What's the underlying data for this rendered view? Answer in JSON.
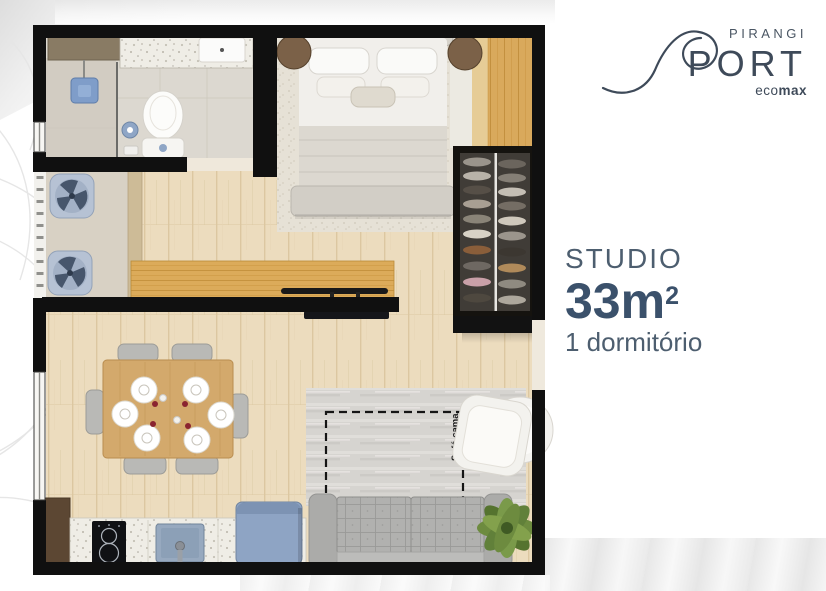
{
  "brand": {
    "name_top": "PIRANGI",
    "name_main": "PORT",
    "eco_prefix": "eco",
    "eco_suffix": "max"
  },
  "unit": {
    "type": "STUDIO",
    "area": "33m",
    "area_exponent": "2",
    "bedrooms": "1 dormitório"
  },
  "floorplan": {
    "sofa_bed_label": "Sofá cama"
  },
  "colors": {
    "brand_navy": "#3E4A59",
    "headline_blue": "#3B516B",
    "subtext_blue": "#4D5E6F",
    "wall_black": "#101010",
    "wood_floor": "#ECDCBE",
    "wood_gold": "#D9A95C",
    "fixture_blue": "#8FA6C6",
    "fridge_blue": "#8EA4C4",
    "sofa_gray": "#B1B1AF",
    "plant_green": "#6D8B3F"
  }
}
